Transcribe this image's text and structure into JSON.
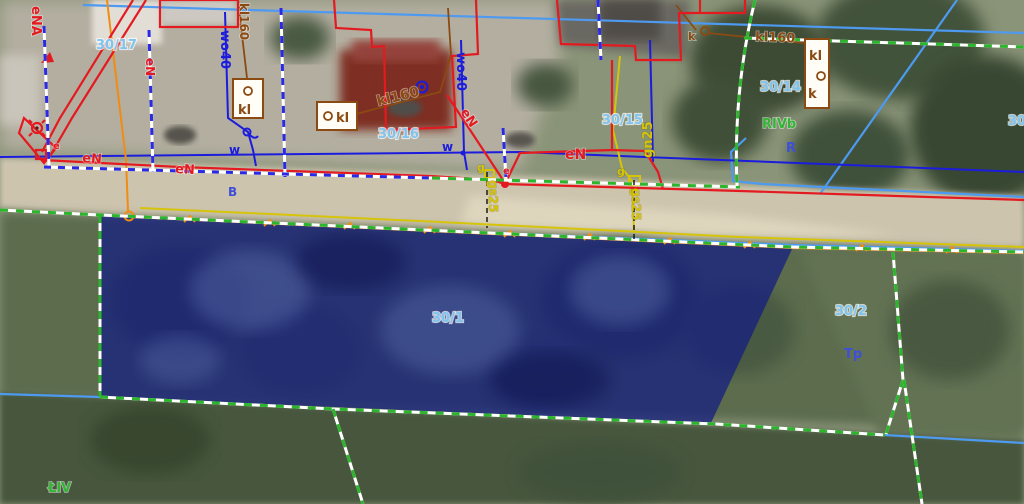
{
  "map": {
    "selected_parcel": "30/1",
    "labels": {
      "ena": "eNA",
      "en_vertical": "eN",
      "parcel_30_17": "30/17",
      "wo40_left": "wo40",
      "kl160_top": "kl160",
      "kl160_mid": "kl160",
      "kl160_right": "kl160",
      "parcel_30_16": "30/16",
      "wo40_mid": "wo40",
      "w_left": "w",
      "w_mid": "w",
      "en_diag": "eN",
      "parcel_30_15": "30/15",
      "gn25": "gn25",
      "parcel_30_14": "30/14",
      "k_right": "k",
      "box1_kl": "kl",
      "box2_kl": "kl",
      "box3_kl": "kl",
      "box3_k": "k",
      "rivb": "RIVb",
      "r_letter": "R",
      "b_letter": "B",
      "en_road_1": "eN",
      "en_road_2": "eN",
      "en_road_3": "eN",
      "e_small_1": "e",
      "e_small_2": "e",
      "g_small_1": "g",
      "g_small_2": "g",
      "gs25_1": "gs25",
      "gs25_2": "gs25",
      "parcel_30_1": "30/1",
      "parcel_30_2": "30/2",
      "tp": "Tp",
      "liv": "ŁIV",
      "parcel_30_edge": "30"
    },
    "colors": {
      "electric_red": "#e31a20",
      "water_dark_blue": "#1c1cdc",
      "light_blue_line": "#4d9af0",
      "sewer_brown": "#8a4a12",
      "gas_yellow": "#d6c409",
      "telecom_orange": "#f08c14",
      "boundary_green": "#2db52d",
      "boundary_blue": "#2a2ae6",
      "parcel_label_blue": "#7ec4ee",
      "land_class_green": "#35b535",
      "letter_blue": "#3f4fd8",
      "selection_fill": "rgba(18,28,130,0.72)"
    }
  }
}
